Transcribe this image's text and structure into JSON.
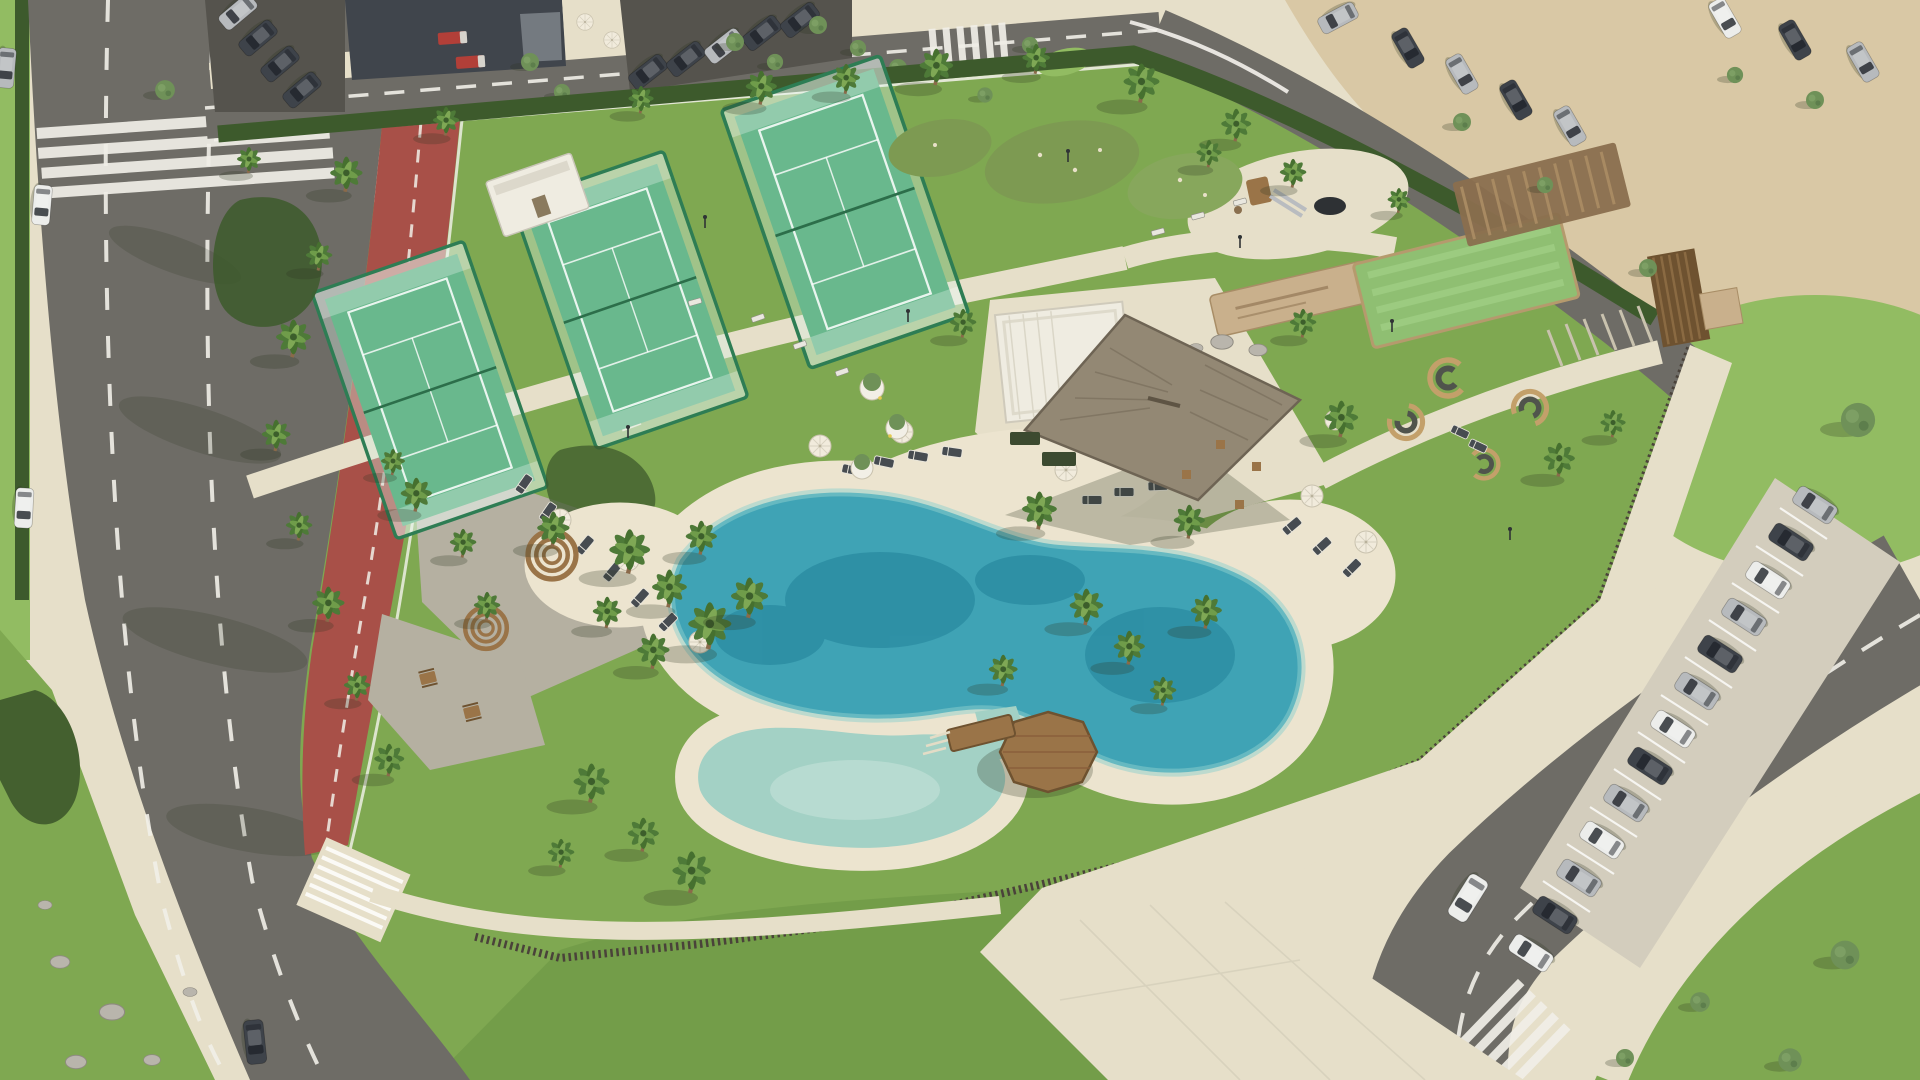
{
  "meta": {
    "title": "Aerial rendering of a beachfront leisure park with lagoon pool, padel courts and parking",
    "image_type": "photographic-render",
    "view": "aerial-oblique",
    "visible_text": "none"
  },
  "palette": {
    "asphalt": "#6e6c66",
    "asphalt_dark": "#55534d",
    "road_line": "#f1efe8",
    "bike_lane": "#a85048",
    "grass": "#7fa851",
    "grass_light": "#92bc62",
    "grass_dark": "#5f8a3c",
    "hedge": "#3d5a2c",
    "path": "#e6dfc9",
    "gravel": "#b5b0a1",
    "sand": "#d9c8a5",
    "beach": "#ece4cf",
    "pool_deep": "#1f7f97",
    "pool_mid": "#3fa3b5",
    "pool_light": "#8ed0cd",
    "kid_pool": "#a3d1c5",
    "padel_turf": "#69b88d",
    "padel_fence": "#2e7d54",
    "thatch": "#938874",
    "thatch_dark": "#6e6454",
    "building_white": "#efece1",
    "building_dark": "#40454c",
    "wood": "#9a7448",
    "wood_dark": "#6e5230",
    "fence_slat": "#4a423a",
    "wicker": "#c3a06a",
    "car_dark": "#3e434a",
    "car_silver": "#b7babd",
    "car_white": "#ecedeb",
    "truck_red": "#b23f38",
    "umbrella": "#f1ebdc",
    "lounger": "#474c51",
    "rock": "#b9b5ac",
    "shadow": "#2a331f"
  },
  "scene": {
    "areas": [
      {
        "name": "padel-courts",
        "count": 3
      },
      {
        "name": "lagoon-pool",
        "count": 1
      },
      {
        "name": "kids-pool",
        "count": 1
      },
      {
        "name": "octagonal-wood-deck-with-bridge",
        "count": 1
      },
      {
        "name": "thatched-roof-pavilion",
        "count": 1
      },
      {
        "name": "white-flat-roof-annex",
        "count": 1
      },
      {
        "name": "storage-cabin",
        "count": 1
      },
      {
        "name": "playground-with-slide",
        "count": 1
      },
      {
        "name": "petanque-turf-court",
        "count": 1
      },
      {
        "name": "pergola",
        "count": 1
      },
      {
        "name": "wicker-seating-pods",
        "count": 4
      },
      {
        "name": "tiered-circular-benches",
        "count": 2
      },
      {
        "name": "swing-frames",
        "count": 2
      },
      {
        "name": "red-bike-lane",
        "count": 1
      },
      {
        "name": "zebra-crosswalks",
        "count": 3
      },
      {
        "name": "wood-slat-perimeter-fence",
        "count": 1
      },
      {
        "name": "sand-lot",
        "count": 1
      }
    ],
    "furniture": {
      "sun_loungers": 19,
      "parasols": 10,
      "park_benches": 7,
      "picnic_tables": 2,
      "planter_pots": 3
    },
    "vehicles": {
      "parked_right_row": 13,
      "parked_top_left": 9,
      "parked_sand_lot": 8,
      "red_trucks": 2,
      "moving_cars": 5
    },
    "vegetation": {
      "palm_trees": 46,
      "round_trees": 20,
      "hedges": "along north and north-east park edge"
    }
  }
}
